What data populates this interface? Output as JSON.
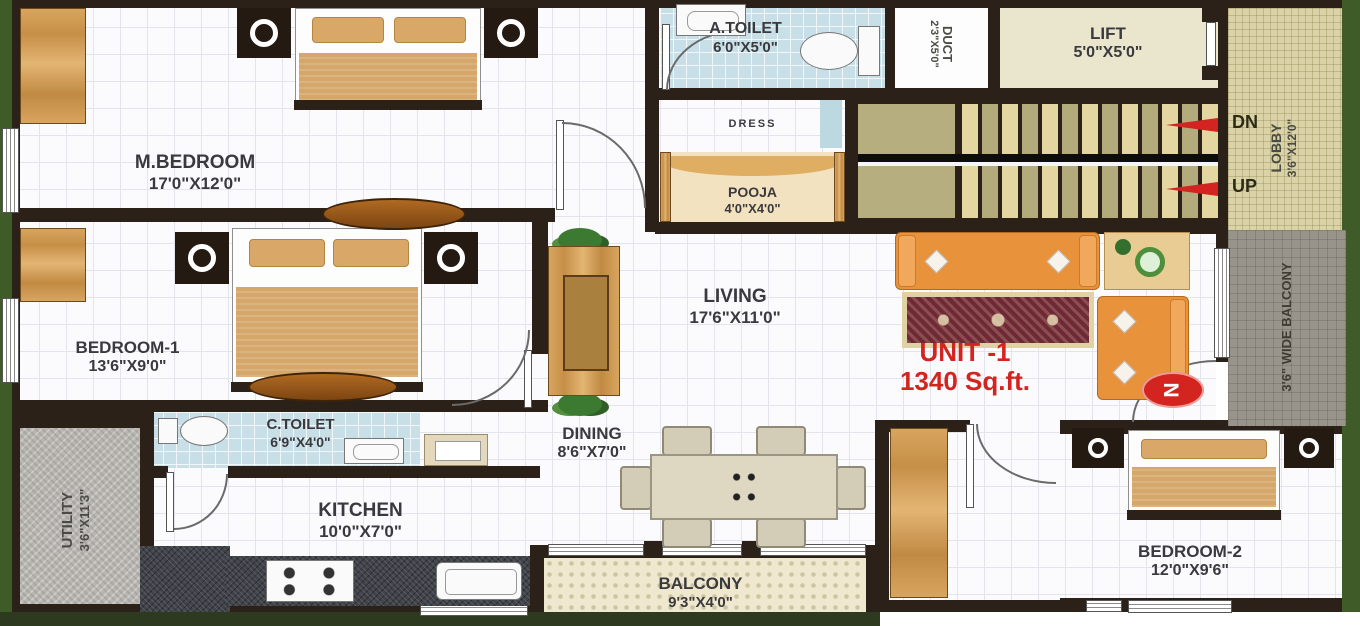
{
  "unit": {
    "name": "UNIT -1",
    "area": "1340 Sq.ft."
  },
  "compass": {
    "north": "N"
  },
  "stairs": {
    "down": "DN",
    "up": "UP"
  },
  "rooms": {
    "m_bedroom": {
      "name": "M.BEDROOM",
      "dims": "17'0\"X12'0\""
    },
    "a_toilet": {
      "name": "A.TOILET",
      "dims": "6'0\"X5'0\""
    },
    "duct": {
      "name": "DUCT",
      "dims": "2'3\"X5'0\""
    },
    "lift": {
      "name": "LIFT",
      "dims": "5'0\"X5'0\""
    },
    "dress": {
      "name": "DRESS"
    },
    "pooja": {
      "name": "POOJA",
      "dims": "4'0\"X4'0\""
    },
    "lobby": {
      "name": "LOBBY",
      "dims": "3'6\"X12'0\""
    },
    "bedroom_1": {
      "name": "BEDROOM-1",
      "dims": "13'6\"X9'0\""
    },
    "living": {
      "name": "LIVING",
      "dims": "17'6\"X11'0\""
    },
    "side_balcony": {
      "name": "3'6\" WIDE BALCONY"
    },
    "c_toilet": {
      "name": "C.TOILET",
      "dims": "6'9\"X4'0\""
    },
    "dining": {
      "name": "DINING",
      "dims": "8'6\"X7'0\""
    },
    "utility": {
      "name": "UTILITY",
      "dims": "3'6\"X11'3\""
    },
    "kitchen": {
      "name": "KITCHEN",
      "dims": "10'0\"X7'0\""
    },
    "balcony": {
      "name": "BALCONY",
      "dims": "9'3\"X4'0\""
    },
    "bedroom_2": {
      "name": "BEDROOM-2",
      "dims": "12'0\"X9'6\""
    }
  },
  "colors": {
    "accent_red": "#d42420",
    "wall": "#2b2119",
    "border_green": "#3f5c28",
    "toilet_tile": "#c8dfe8",
    "stair_tread_light": "#e3d6a1",
    "stair_tread_dark": "#b3ab7c",
    "lobby_tile": "#dbd3a8",
    "sofa_orange": "#e8923b"
  }
}
